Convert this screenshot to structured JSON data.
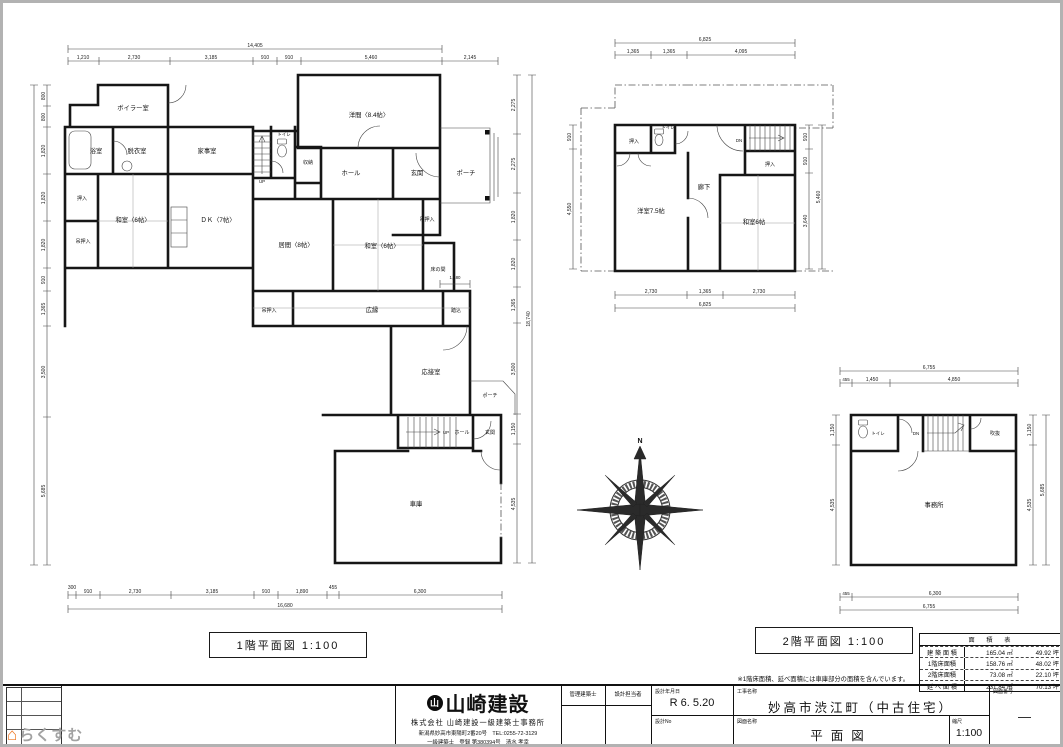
{
  "watermark": {
    "text": "らくすむ"
  },
  "compass": {
    "north": "N"
  },
  "floor1": {
    "caption": "1階平面図 1:100",
    "rooms": {
      "boiler": "ボイラー室",
      "bath": "浴室",
      "dressing": "脱衣室",
      "utility": "家事室",
      "toilet": "トイレ",
      "up": "UP",
      "storage": "収納",
      "western": "洋間〈8.4帖〉",
      "hall": "ホール",
      "entry": "玄関",
      "porch": "ポーチ",
      "closet": "押入",
      "tatami_w": "和室〈6帖〉",
      "dk": "ＤＫ〈7帖〉",
      "hang_closet1": "吊押入",
      "hang_closet2": "吊押入",
      "living": "居間〈8帖〉",
      "tatami_m": "和室〈6帖〉",
      "tokonoma": "床の間",
      "hang_closet3": "吊押入",
      "veranda": "広縁",
      "fumikomi": "踏込",
      "reception": "応接室",
      "porch2": "ポーチ",
      "up2": "UP",
      "hall2": "ホール",
      "entry2": "玄関",
      "garage": "車庫"
    },
    "dims": {
      "top_total": "14,405",
      "top": [
        "1,210",
        "2,730",
        "3,185",
        "910",
        "910",
        "5,460",
        "2,145"
      ],
      "bottom": [
        "300",
        "910",
        "2,730",
        "3,185",
        "910",
        "1,890",
        "455",
        "6,300"
      ],
      "bottom_total": "16,680",
      "left": [
        "800",
        "800",
        "1,820",
        "1,820",
        "1,820",
        "910",
        "1,365",
        "3,500",
        "5,685"
      ],
      "right": [
        "2,275",
        "2,275",
        "1,820",
        "1,820",
        "1,365",
        "3,500",
        "1,150",
        "4,535"
      ],
      "right_total": "18,740",
      "inner": "1,180"
    }
  },
  "floor2": {
    "caption": "2階平面図 1:100",
    "rooms": {
      "closet1": "押入",
      "toilet": "トイレ",
      "dn": "DN",
      "closet2": "押入",
      "corridor": "廊下",
      "western": "洋室7.5帖",
      "tatami": "和室6帖"
    },
    "dims": {
      "top_total": "6,825",
      "top": [
        "1,365",
        "1,365",
        "4,095"
      ],
      "bottom": [
        "2,730",
        "1,365",
        "2,730"
      ],
      "bottom_total": "6,825",
      "right": [
        "910",
        "910",
        "3,640"
      ],
      "right_total": "5,460",
      "left": [
        "910",
        "4,550"
      ]
    }
  },
  "office": {
    "rooms": {
      "toilet": "トイレ",
      "dn": "DN",
      "void": "吹抜",
      "office": "事務所"
    },
    "dims": {
      "top_total": "6,755",
      "top": [
        "455",
        "1,450",
        "4,850"
      ],
      "bottom": [
        "455",
        "6,300"
      ],
      "bottom_total": "6,755",
      "right": [
        "1,150",
        "4,535"
      ],
      "right_total": "5,685",
      "left": [
        "1,150",
        "4,535"
      ]
    }
  },
  "area_table": {
    "title": "面 積 表",
    "rows": [
      {
        "label": "建 築 面 積",
        "sqm": "165.04 ㎡",
        "tsubo": "49.92 坪"
      },
      {
        "label": "1階床面積",
        "sqm": "158.76 ㎡",
        "tsubo": "48.02 坪"
      },
      {
        "label": "2階床面積",
        "sqm": "73.08 ㎡",
        "tsubo": "22.10 坪"
      },
      {
        "label": "延 べ 面 積",
        "sqm": "231.84 ㎡",
        "tsubo": "70.13 坪"
      }
    ],
    "note": "※1階床面積、延べ面積には車庫部分の面積を含んでいます。"
  },
  "title_block": {
    "logo_mark": "山",
    "logo_text": "山崎建設",
    "company_line": "株式会社 山崎建設一級建築士事務所",
    "address_line": "新潟県妙高市東陽町2番20号　TEL:0255-72-3129",
    "license_line": "一級建築士　登録 第380394号　清水 孝幸",
    "labels": {
      "manager": "管理建築士",
      "designer": "設計担当者",
      "date_label": "設計年月日",
      "no_label": "設計No",
      "project_label": "工事名称",
      "drawing_label": "図面名称",
      "scale_label": "縮尺",
      "sheet_label": "図面番号"
    },
    "values": {
      "date": "R 6. 5.20",
      "project": "妙高市渋江町（中古住宅）",
      "drawing": "平面図",
      "scale": "1:100",
      "sheet": "—"
    }
  }
}
